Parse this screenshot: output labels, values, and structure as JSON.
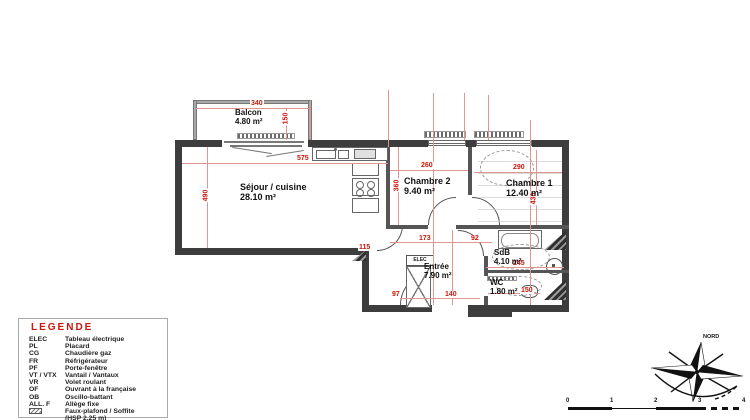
{
  "plan": {
    "rooms": [
      {
        "id": "balcon",
        "name": "Balcon",
        "area": "4.80 m²"
      },
      {
        "id": "sejour",
        "name": "Séjour / cuisine",
        "area": "28.10 m²"
      },
      {
        "id": "chambre2",
        "name": "Chambre 2",
        "area": "9.40 m²"
      },
      {
        "id": "chambre1",
        "name": "Chambre 1",
        "area": "12.40 m²"
      },
      {
        "id": "sdb",
        "name": "SdB",
        "area": "4.10 m²"
      },
      {
        "id": "wc",
        "name": "WC",
        "area": "1.80 m²"
      },
      {
        "id": "entree",
        "name": "Entrée",
        "area": "7.90 m²"
      }
    ],
    "labels": {
      "elec": "ELEC"
    },
    "dims": {
      "balcon_w": "340",
      "balcon_d": "150",
      "sejour_w": "575",
      "sejour_h": "490",
      "ch2_w": "260",
      "ch2_h": "360",
      "ch1_w": "290",
      "ch1_h": "430",
      "hall_a": "173",
      "hall_b": "92",
      "sdb_w": "245",
      "wc_w": "150",
      "entree_w": "140",
      "placard": "97",
      "passage": "115"
    }
  },
  "legend": {
    "title": "LEGENDE",
    "items": [
      {
        "abbr": "ELEC",
        "label": "Tableau électrique"
      },
      {
        "abbr": "PL",
        "label": "Placard"
      },
      {
        "abbr": "CG",
        "label": "Chaudière gaz"
      },
      {
        "abbr": "FR",
        "label": "Réfrigérateur"
      },
      {
        "abbr": "PF",
        "label": "Porte-fenêtre"
      },
      {
        "abbr": "VT / VTX",
        "label": "Vantail / Vantaux"
      },
      {
        "abbr": "VR",
        "label": "Volet roulant"
      },
      {
        "abbr": "OF",
        "label": "Ouvrant à la française"
      },
      {
        "abbr": "OB",
        "label": "Oscillo-battant"
      },
      {
        "abbr": "ALL. F",
        "label": "Allège fixe"
      },
      {
        "abbr": "",
        "label": "Faux-plafond / Soffite",
        "label2": "(HSP 2,25 m)"
      }
    ]
  },
  "compass": {
    "north": "NORD"
  },
  "scalebar": {
    "ticks": [
      "0",
      "1",
      "2",
      "3",
      "4"
    ]
  }
}
